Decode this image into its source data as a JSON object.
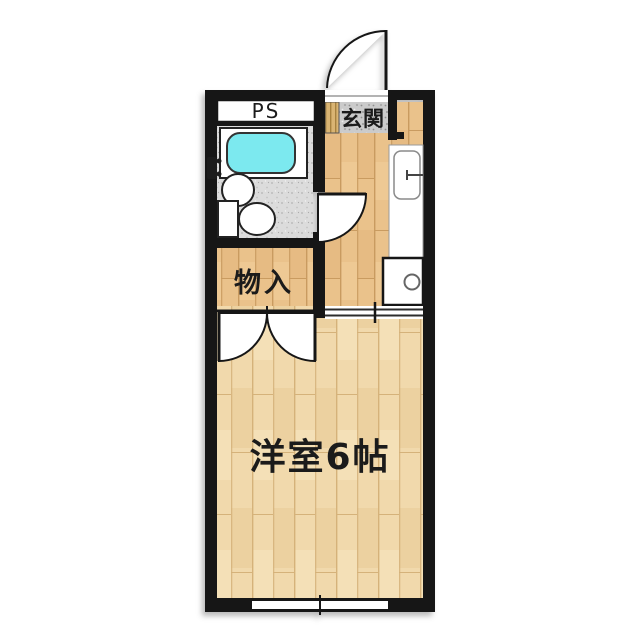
{
  "floorplan": {
    "labels": {
      "pipe_space": "PS",
      "entrance": "玄関",
      "closet": "物入",
      "main_room": "洋室6帖"
    },
    "colors": {
      "wall": "#161616",
      "bathtub_water": "#7ce9ef",
      "hall_wood": "#eac28b",
      "room_wood": "#f1d9ac",
      "bath_tile": "#dcdcdc",
      "genkan_stone": "#cbcbcb",
      "background": "#ffffff"
    },
    "fixtures": [
      "bathtub",
      "washbasin",
      "toilet",
      "bath-faucet",
      "kitchen-counter",
      "kitchen-sink",
      "stove-burner",
      "entrance-door",
      "bathroom-door",
      "closet-double-door",
      "room-sliding-door",
      "window",
      "genkan-step"
    ]
  }
}
